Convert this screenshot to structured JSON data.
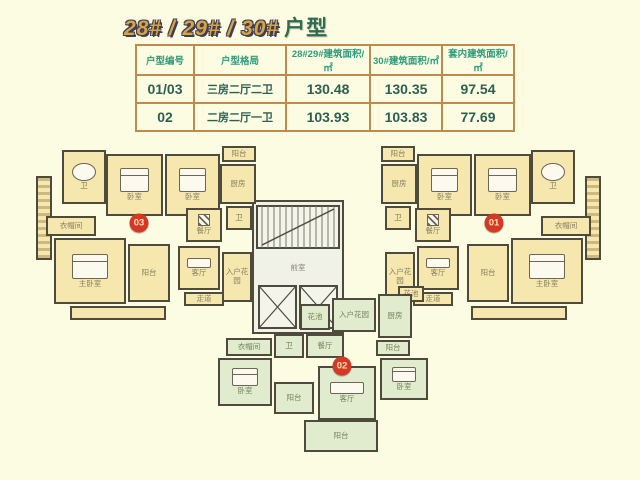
{
  "colors": {
    "background": "#FBFCE2",
    "accent_gold": "#D9A440",
    "title_green": "#2F6B4E",
    "table_border": "#C08A4E",
    "header_text": "#2E9B7C",
    "cell_text": "#2E5F53",
    "unit_yellow": "#F6E7AE",
    "unit_green": "#E1ECCE",
    "badge_red": "#D63826"
  },
  "title": {
    "main": "28# / 29# / 30#",
    "suffix": "户型"
  },
  "table": {
    "headers": [
      "户型编号",
      "户型格局",
      "28#29#建筑面积/㎡",
      "30#建筑面积/㎡",
      "套内建筑面积/㎡"
    ],
    "rows": [
      [
        "01/03",
        "三房二厅二卫",
        "130.48",
        "130.35",
        "97.54"
      ],
      [
        "02",
        "二房二厅一卫",
        "103.93",
        "103.83",
        "77.69"
      ]
    ]
  },
  "floorplan": {
    "core": {
      "anteroom_label": "前室"
    },
    "badges": [
      {
        "label": "03",
        "x": 139,
        "y": 223
      },
      {
        "label": "02",
        "x": 342,
        "y": 366
      },
      {
        "label": "01",
        "x": 494,
        "y": 223
      }
    ],
    "rooms": [
      {
        "label": "卫",
        "x": 62,
        "y": 150,
        "w": 44,
        "h": 54,
        "fill": "y",
        "furn": "tub"
      },
      {
        "label": "卧室",
        "x": 106,
        "y": 154,
        "w": 57,
        "h": 62,
        "fill": "y",
        "furn": "bed"
      },
      {
        "label": "卧室",
        "x": 165,
        "y": 154,
        "w": 55,
        "h": 62,
        "fill": "y",
        "furn": "bed"
      },
      {
        "label": "阳台",
        "x": 222,
        "y": 146,
        "w": 34,
        "h": 16,
        "fill": "y"
      },
      {
        "label": "厨房",
        "x": 220,
        "y": 164,
        "w": 36,
        "h": 40,
        "fill": "y"
      },
      {
        "label": "衣帽间",
        "x": 46,
        "y": 216,
        "w": 50,
        "h": 20,
        "fill": "y"
      },
      {
        "label": "主卧室",
        "x": 54,
        "y": 238,
        "w": 72,
        "h": 66,
        "fill": "y",
        "furn": "bed"
      },
      {
        "label": "阳台",
        "x": 128,
        "y": 244,
        "w": 42,
        "h": 58,
        "fill": "y"
      },
      {
        "label": "餐厅",
        "x": 186,
        "y": 208,
        "w": 36,
        "h": 34,
        "fill": "y",
        "furn": "table"
      },
      {
        "label": "卫",
        "x": 226,
        "y": 206,
        "w": 26,
        "h": 24,
        "fill": "y"
      },
      {
        "label": "客厅",
        "x": 178,
        "y": 246,
        "w": 42,
        "h": 44,
        "fill": "y",
        "furn": "sofa"
      },
      {
        "label": "入户花园",
        "x": 222,
        "y": 252,
        "w": 30,
        "h": 50,
        "fill": "y"
      },
      {
        "label": "",
        "x": 70,
        "y": 306,
        "w": 96,
        "h": 14,
        "fill": "y"
      },
      {
        "label": "走道",
        "x": 184,
        "y": 292,
        "w": 40,
        "h": 14,
        "fill": "y"
      },
      {
        "label": "卫",
        "x": 531,
        "y": 150,
        "w": 44,
        "h": 54,
        "fill": "y",
        "furn": "tub"
      },
      {
        "label": "卧室",
        "x": 474,
        "y": 154,
        "w": 57,
        "h": 62,
        "fill": "y",
        "furn": "bed"
      },
      {
        "label": "卧室",
        "x": 417,
        "y": 154,
        "w": 55,
        "h": 62,
        "fill": "y",
        "furn": "bed"
      },
      {
        "label": "阳台",
        "x": 381,
        "y": 146,
        "w": 34,
        "h": 16,
        "fill": "y"
      },
      {
        "label": "厨房",
        "x": 381,
        "y": 164,
        "w": 36,
        "h": 40,
        "fill": "y"
      },
      {
        "label": "衣帽间",
        "x": 541,
        "y": 216,
        "w": 50,
        "h": 20,
        "fill": "y"
      },
      {
        "label": "主卧室",
        "x": 511,
        "y": 238,
        "w": 72,
        "h": 66,
        "fill": "y",
        "furn": "bed"
      },
      {
        "label": "阳台",
        "x": 467,
        "y": 244,
        "w": 42,
        "h": 58,
        "fill": "y"
      },
      {
        "label": "餐厅",
        "x": 415,
        "y": 208,
        "w": 36,
        "h": 34,
        "fill": "y",
        "furn": "table"
      },
      {
        "label": "卫",
        "x": 385,
        "y": 206,
        "w": 26,
        "h": 24,
        "fill": "y"
      },
      {
        "label": "客厅",
        "x": 417,
        "y": 246,
        "w": 42,
        "h": 44,
        "fill": "y",
        "furn": "sofa"
      },
      {
        "label": "入户花园",
        "x": 385,
        "y": 252,
        "w": 30,
        "h": 50,
        "fill": "y"
      },
      {
        "label": "",
        "x": 471,
        "y": 306,
        "w": 96,
        "h": 14,
        "fill": "y"
      },
      {
        "label": "走道",
        "x": 413,
        "y": 292,
        "w": 40,
        "h": 14,
        "fill": "y"
      },
      {
        "label": "花池",
        "x": 398,
        "y": 286,
        "w": 26,
        "h": 16,
        "fill": "y"
      },
      {
        "label": "花池",
        "x": 300,
        "y": 304,
        "w": 30,
        "h": 26,
        "fill": "g"
      },
      {
        "label": "入户花园",
        "x": 332,
        "y": 298,
        "w": 44,
        "h": 34,
        "fill": "g"
      },
      {
        "label": "厨房",
        "x": 378,
        "y": 294,
        "w": 34,
        "h": 44,
        "fill": "g"
      },
      {
        "label": "阳台",
        "x": 376,
        "y": 340,
        "w": 34,
        "h": 16,
        "fill": "g"
      },
      {
        "label": "衣帽间",
        "x": 226,
        "y": 338,
        "w": 46,
        "h": 18,
        "fill": "g"
      },
      {
        "label": "卫",
        "x": 274,
        "y": 334,
        "w": 30,
        "h": 24,
        "fill": "g"
      },
      {
        "label": "餐厅",
        "x": 306,
        "y": 334,
        "w": 38,
        "h": 24,
        "fill": "g"
      },
      {
        "label": "卧室",
        "x": 218,
        "y": 358,
        "w": 54,
        "h": 48,
        "fill": "g",
        "furn": "bed"
      },
      {
        "label": "阳台",
        "x": 274,
        "y": 382,
        "w": 40,
        "h": 32,
        "fill": "g"
      },
      {
        "label": "客厅",
        "x": 318,
        "y": 366,
        "w": 58,
        "h": 54,
        "fill": "g",
        "furn": "sofa"
      },
      {
        "label": "卧室",
        "x": 380,
        "y": 358,
        "w": 48,
        "h": 42,
        "fill": "g",
        "furn": "bed"
      },
      {
        "label": "阳台",
        "x": 304,
        "y": 420,
        "w": 74,
        "h": 32,
        "fill": "g"
      }
    ]
  }
}
